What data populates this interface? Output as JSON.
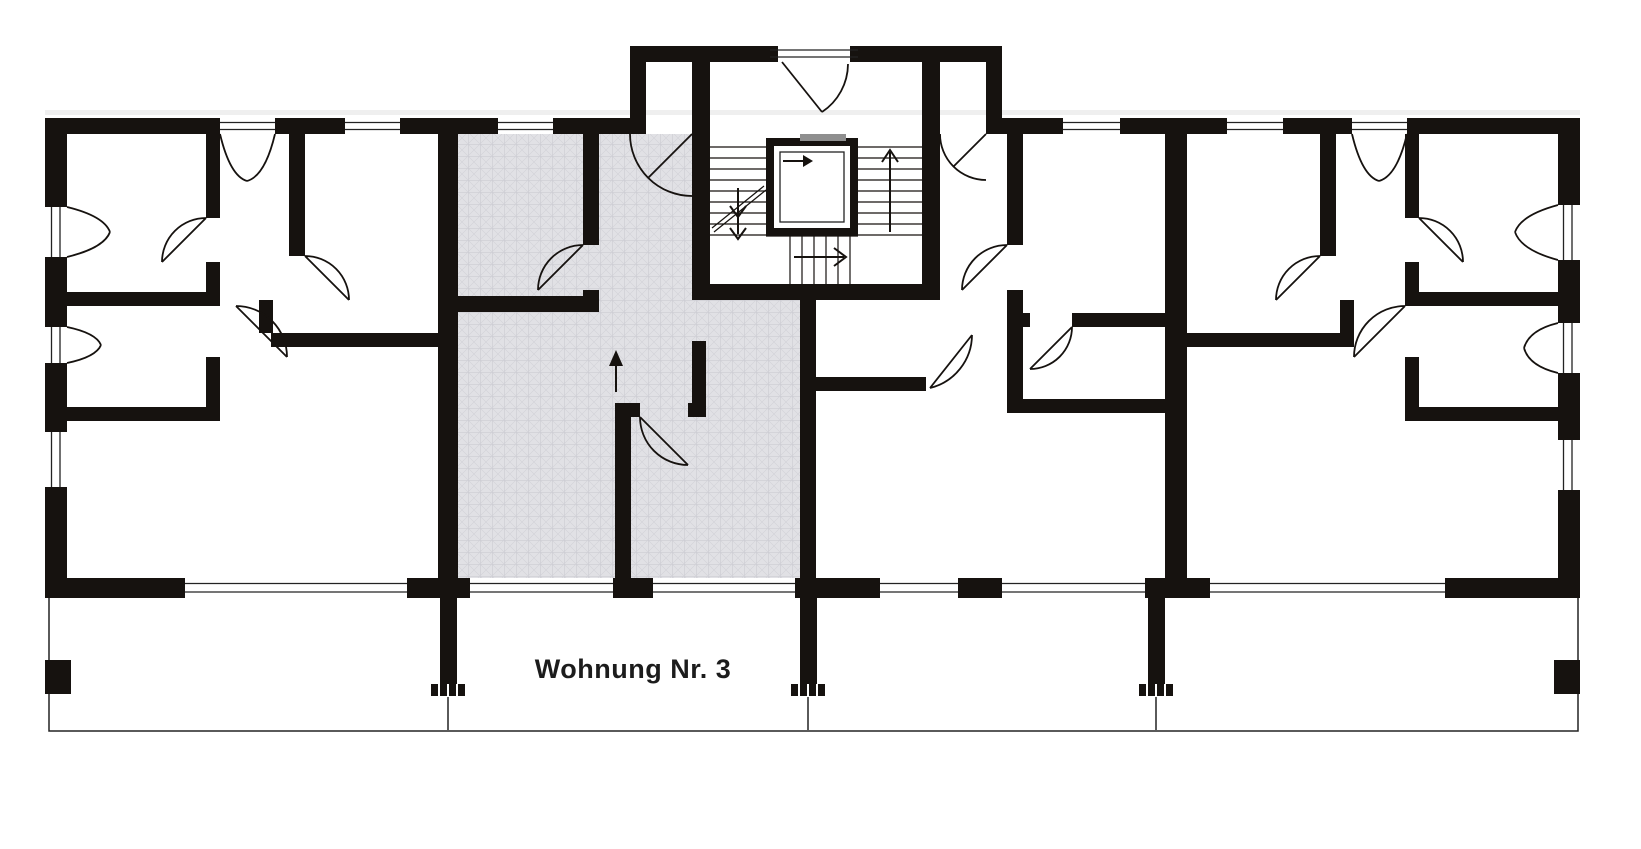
{
  "floor_plan": {
    "label": "Wohnung Nr. 3",
    "colors": {
      "background": "#ffffff",
      "walls": "#16120f",
      "thin_line": "#232323",
      "highlight": "#e1e1e5",
      "highlight_grid": "#c6c6cd",
      "highlight_hatch": "#d2d2d8",
      "elevator_door": "#8f8f8f"
    }
  }
}
